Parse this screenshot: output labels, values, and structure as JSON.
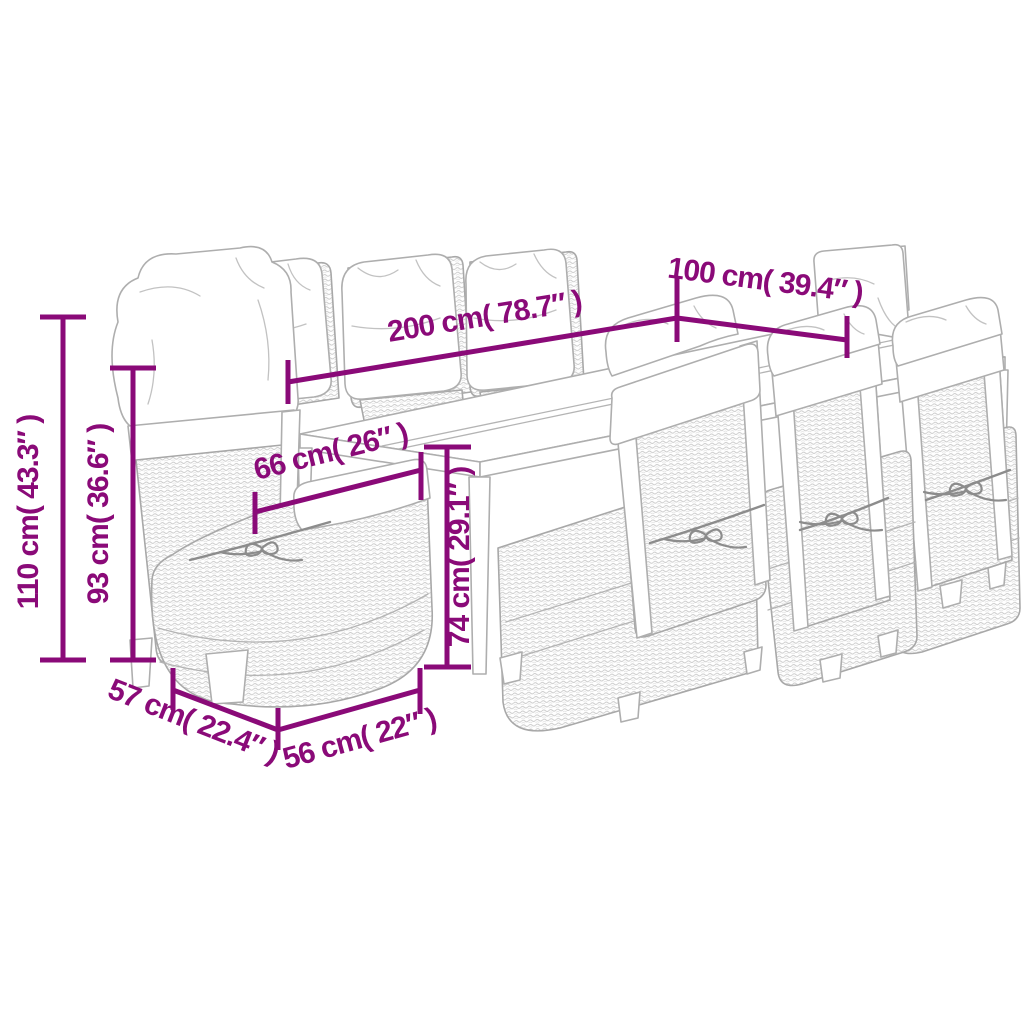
{
  "dims": {
    "d200": "200 cm( 78.7″ )",
    "d100": "100 cm( 39.4″ )",
    "d110": "110 cm( 43.3″ )",
    "d93": "93 cm( 36.6″ )",
    "d66": "66 cm( 26″ )",
    "d74": "74 cm( 29.1″ )",
    "d57": "57 cm( 22.4″ )",
    "d56": "56 cm( 22″ )"
  },
  "colors": {
    "dimension_accent": "#8a0a78",
    "line_art_gray": "#aeaeae",
    "background": "#ffffff"
  },
  "scene": {
    "type": "outdoor dining set line-art",
    "chairs_visible": 8,
    "table_panels": 2
  }
}
